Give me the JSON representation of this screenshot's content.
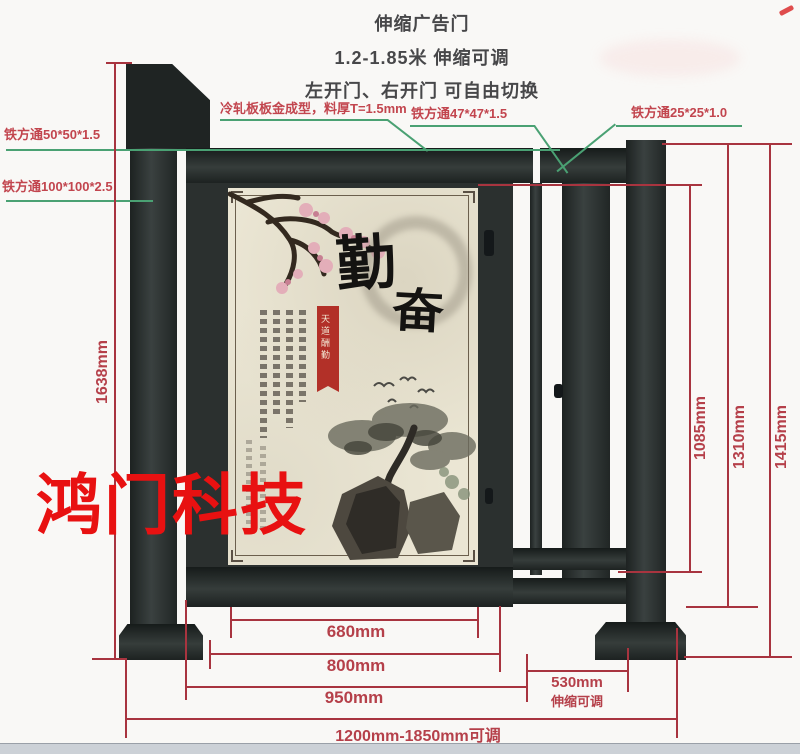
{
  "title": {
    "line1": "伸缩广告门",
    "line2": "1.2-1.85米 伸缩可调",
    "line3": "左开门、右开门 可自由切换"
  },
  "callouts": {
    "cold_rolled": "冷轧板板金成型，料厚T=1.5mm",
    "tube50": "铁方通50*50*1.5",
    "tube100": "铁方通100*100*2.5",
    "tube47": "铁方通47*47*1.5",
    "tube25": "铁方通25*25*1.0"
  },
  "dimensions": {
    "left_total": "1638mm",
    "right_inner": "1085mm",
    "right_mid": "1310mm",
    "right_outer": "1415mm",
    "panel_width": "680mm",
    "leaf_width": "800mm",
    "gate_width": "950mm",
    "ext_width": "530mm",
    "ext_note": "伸缩可调",
    "total_range": "1200mm-1850mm可调"
  },
  "poster": {
    "calligraphy_main": "勤",
    "calligraphy_sub": "奋",
    "seal_text": "天道酬勤"
  },
  "watermark": "鸿门科技",
  "colors": {
    "dimension_red": "#a8343f",
    "callout_green": "#4aa173",
    "callout_label_red": "#c2454e",
    "watermark_red": "#e81111",
    "metal_dark": "#2b302f",
    "poster_beige": "#ebe6d4"
  }
}
